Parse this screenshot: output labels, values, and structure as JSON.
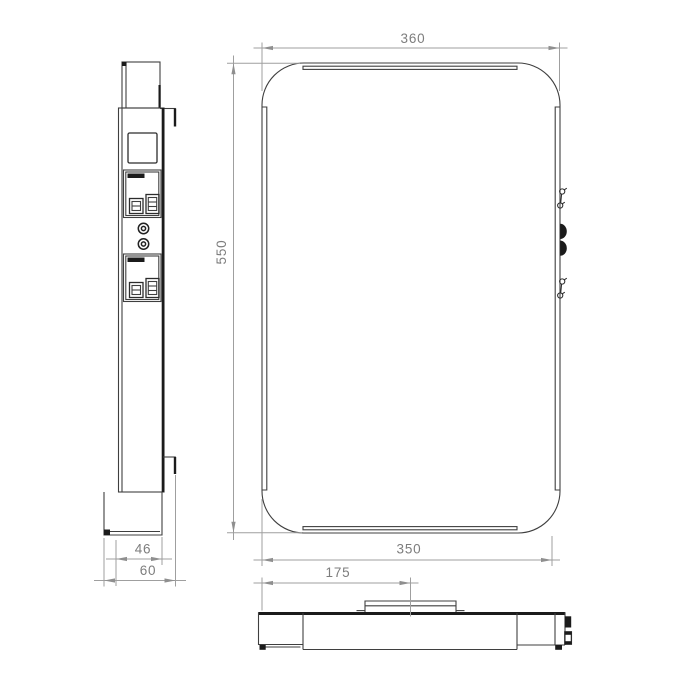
{
  "colors": {
    "background": "#ffffff",
    "object_line": "#3f3f3f",
    "object_bold": "#1b1b1b",
    "dimension_line": "#9f9f9f",
    "dimension_text": "#7d7d7d"
  },
  "drawing": {
    "dimensions": {
      "front_width_top": "360",
      "front_height": "550",
      "front_width_bottom": "350",
      "side_body_depth": "46",
      "side_total_depth": "60",
      "bottom_center_offset": "175"
    }
  }
}
